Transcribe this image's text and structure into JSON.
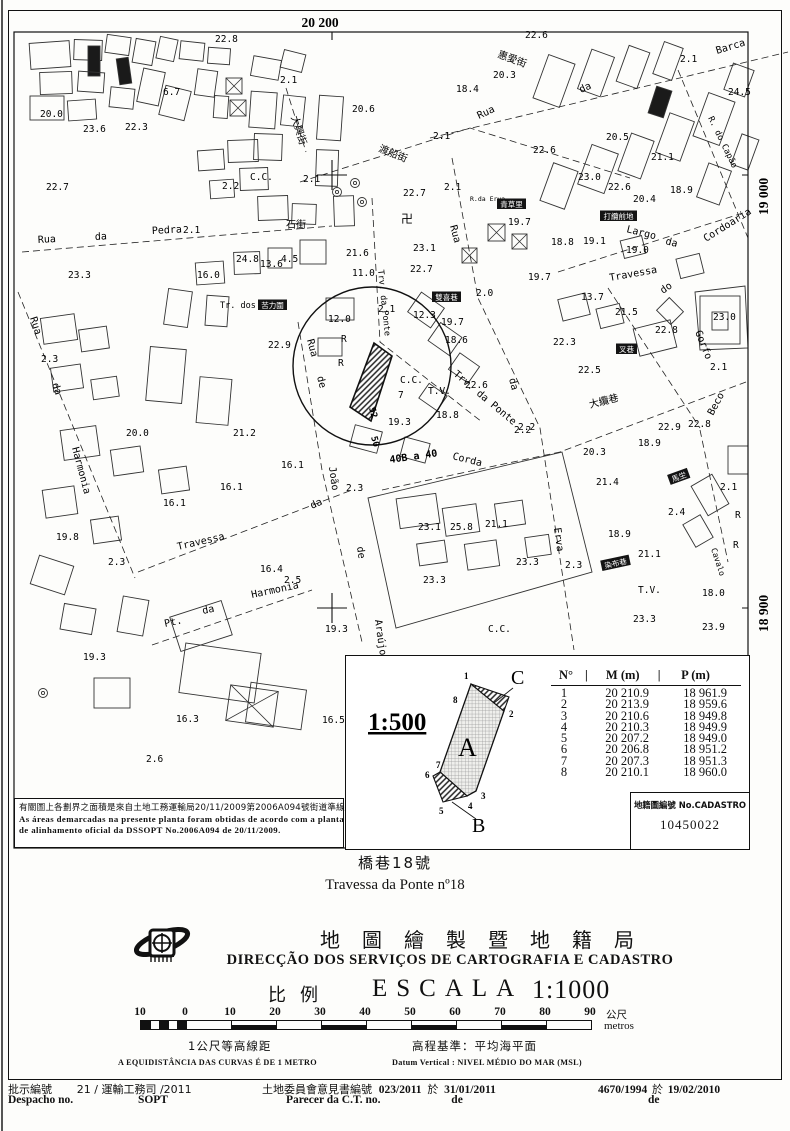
{
  "map": {
    "grid": {
      "top": "20 200",
      "right_upper": "19 000",
      "right_lower": "18 900"
    },
    "street_labels": [
      [
        "惠愛街",
        497,
        57,
        20,
        "zh"
      ],
      [
        "渡船街",
        378,
        151,
        22,
        "zh"
      ],
      [
        "大興街",
        291,
        117,
        72,
        "zh"
      ],
      [
        "石街",
        286,
        228,
        0,
        "zh"
      ],
      [
        "Rua",
        38,
        243,
        -3
      ],
      [
        "da",
        95,
        240,
        -3
      ],
      [
        "Pedra",
        152,
        234,
        -3
      ],
      [
        "Rua",
        30,
        318,
        72
      ],
      [
        "da",
        52,
        384,
        72
      ],
      [
        "Harmonia",
        72,
        448,
        75
      ],
      [
        "Travessa",
        178,
        550,
        -13
      ],
      [
        "da",
        312,
        509,
        -25
      ],
      [
        "Pt.",
        165,
        627,
        -12
      ],
      [
        "da",
        203,
        614,
        -12
      ],
      [
        "Harmonia",
        252,
        598,
        -12
      ],
      [
        "Tr. dos Cules",
        220,
        308,
        0,
        "mo",
        8.5
      ],
      [
        "Rua",
        307,
        340,
        75
      ],
      [
        "de",
        317,
        377,
        75
      ],
      [
        "João",
        329,
        467,
        82
      ],
      [
        "de",
        357,
        547,
        82
      ],
      [
        "Araújo",
        375,
        620,
        82
      ],
      [
        "Trv. da Ponte",
        378,
        270,
        84,
        "mo",
        8.5
      ],
      [
        "Trv. da Ponte",
        453,
        375,
        40
      ],
      [
        "Corda",
        452,
        459,
        14
      ],
      [
        "Rua",
        450,
        226,
        75
      ],
      [
        "da",
        509,
        379,
        75
      ],
      [
        "Erva",
        554,
        528,
        82
      ],
      [
        "Rua",
        479,
        119,
        -25
      ],
      [
        "da",
        581,
        93,
        -25
      ],
      [
        "Barca",
        717,
        54,
        -17
      ],
      [
        "R. do Capão",
        708,
        118,
        64,
        "mo",
        8.5
      ],
      [
        "Largo",
        626,
        232,
        14
      ],
      [
        "da",
        665,
        244,
        14
      ],
      [
        "Cordoaria",
        706,
        242,
        -32
      ],
      [
        "Travessa",
        610,
        281,
        -10
      ],
      [
        "do",
        663,
        294,
        -35
      ],
      [
        "Gorfo",
        695,
        332,
        68
      ],
      [
        "大纜巷",
        590,
        408,
        -14,
        "zh"
      ],
      [
        "Beco",
        713,
        416,
        -62
      ],
      [
        "Cavalo",
        711,
        549,
        72,
        "mo",
        8
      ],
      [
        "R.da Erva",
        470,
        201,
        0,
        "mo",
        6.5
      ],
      [
        "52",
        369,
        408,
        75,
        "bd",
        9
      ],
      [
        "50",
        371,
        437,
        75,
        "bd",
        9
      ],
      [
        "40B a 40",
        390,
        463,
        -8,
        "bd",
        10
      ]
    ],
    "chips": [
      [
        "雙喜巷",
        432,
        300,
        0
      ],
      [
        "打纜前地",
        600,
        219,
        0
      ],
      [
        "染布巷",
        602,
        569,
        -12
      ],
      [
        "苦力圍",
        258,
        308,
        0
      ],
      [
        "青草里",
        497,
        207,
        0
      ],
      [
        "馬坣",
        670,
        483,
        -20
      ],
      [
        "叉巷",
        616,
        352,
        0
      ]
    ],
    "elevations": [
      [
        "22.8",
        215,
        42
      ],
      [
        "2.1",
        280,
        83
      ],
      [
        "20.0",
        40,
        117
      ],
      [
        "23.6",
        83,
        132
      ],
      [
        "22.3",
        125,
        130
      ],
      [
        "6.7",
        163,
        95
      ],
      [
        "22.7",
        46,
        190
      ],
      [
        "C.C.",
        250,
        180
      ],
      [
        "20.6",
        352,
        112
      ],
      [
        "2.1",
        303,
        182
      ],
      [
        "2.2",
        222,
        189
      ],
      [
        "2.1",
        433,
        139
      ],
      [
        "22.7",
        403,
        196
      ],
      [
        "2.1",
        444,
        190
      ],
      [
        "23.1",
        413,
        251
      ],
      [
        "22.7",
        410,
        272
      ],
      [
        "21.6",
        346,
        256
      ],
      [
        "11.0",
        352,
        276
      ],
      [
        "2.1",
        183,
        233
      ],
      [
        "23.3",
        68,
        278
      ],
      [
        "16.0",
        197,
        278
      ],
      [
        "24.8",
        236,
        262
      ],
      [
        "13.6",
        260,
        267
      ],
      [
        "4.5",
        281,
        262
      ],
      [
        "22.9",
        268,
        348
      ],
      [
        "2.3",
        41,
        362
      ],
      [
        "20.0",
        126,
        436
      ],
      [
        "21.2",
        233,
        436
      ],
      [
        "16.1",
        281,
        468
      ],
      [
        "16.1",
        220,
        490
      ],
      [
        "16.1",
        163,
        506
      ],
      [
        "19.8",
        56,
        540
      ],
      [
        "2.3",
        108,
        565
      ],
      [
        "16.4",
        260,
        572
      ],
      [
        "2.5",
        284,
        583
      ],
      [
        "19.3",
        325,
        632
      ],
      [
        "19.3",
        83,
        660
      ],
      [
        "16.3",
        176,
        722
      ],
      [
        "2.6",
        146,
        762
      ],
      [
        "16.5",
        322,
        723
      ],
      [
        "12.0",
        328,
        322
      ],
      [
        "2.1",
        378,
        312
      ],
      [
        "12.3",
        413,
        318
      ],
      [
        "19.7",
        441,
        325
      ],
      [
        "18.6",
        445,
        343
      ],
      [
        "2.0",
        476,
        296
      ],
      [
        "22.6",
        465,
        388
      ],
      [
        "18.8",
        436,
        418
      ],
      [
        "19.3",
        388,
        425
      ],
      [
        "7",
        398,
        398
      ],
      [
        "2.2",
        514,
        433
      ],
      [
        "R",
        341,
        342
      ],
      [
        "R",
        338,
        366
      ],
      [
        "C.C.",
        400,
        383
      ],
      [
        "2.3",
        346,
        491
      ],
      [
        "23.1",
        418,
        530
      ],
      [
        "25.8",
        450,
        530
      ],
      [
        "21.1",
        485,
        527
      ],
      [
        "23.3",
        516,
        565
      ],
      [
        "23.3",
        423,
        583
      ],
      [
        "2.3",
        565,
        568
      ],
      [
        "C.C.",
        488,
        632
      ],
      [
        "18.4",
        456,
        92
      ],
      [
        "20.3",
        493,
        78
      ],
      [
        "22.6",
        525,
        38
      ],
      [
        "2.1",
        680,
        62
      ],
      [
        "24.5",
        728,
        95
      ],
      [
        "22.6",
        533,
        153
      ],
      [
        "23.0",
        578,
        180
      ],
      [
        "20.5",
        606,
        140
      ],
      [
        "21.1",
        651,
        160
      ],
      [
        "18.9",
        670,
        193
      ],
      [
        "20.4",
        633,
        202
      ],
      [
        "22.6",
        608,
        190
      ],
      [
        "19.7",
        508,
        225
      ],
      [
        "18.8",
        551,
        245
      ],
      [
        "19.1",
        583,
        244
      ],
      [
        "19.0",
        626,
        253
      ],
      [
        "19.7",
        528,
        280
      ],
      [
        "13.7",
        581,
        300
      ],
      [
        "21.5",
        615,
        315
      ],
      [
        "23.0",
        713,
        320
      ],
      [
        "22.8",
        655,
        333
      ],
      [
        "22.3",
        553,
        345
      ],
      [
        "22.5",
        578,
        373
      ],
      [
        "2.1",
        710,
        370
      ],
      [
        "2.2",
        518,
        430
      ],
      [
        "22.9",
        658,
        430
      ],
      [
        "22.8",
        688,
        427
      ],
      [
        "18.9",
        638,
        446
      ],
      [
        "20.3",
        583,
        455
      ],
      [
        "21.4",
        596,
        485
      ],
      [
        "2.1",
        720,
        490
      ],
      [
        "2.4",
        668,
        515
      ],
      [
        "18.9",
        608,
        537
      ],
      [
        "21.1",
        638,
        557
      ],
      [
        "23.3",
        633,
        622
      ],
      [
        "18.0",
        702,
        596
      ],
      [
        "23.9",
        702,
        630
      ],
      [
        "R",
        735,
        518
      ],
      [
        "R",
        733,
        548
      ],
      [
        "T.V.",
        638,
        593
      ],
      [
        "T.V.",
        428,
        394
      ]
    ]
  },
  "note": {
    "line_zh": "有關圖上各劃界之面積是來自土地工務運輸局20/11/2009第2006A094號街道準線圖.",
    "line_pt1": "As áreas demarcadas na presente planta foram obtidas de acordo com a planta",
    "line_pt2": "de alinhamento oficial da DSSOPT No.2006A094 de 20/11/2009."
  },
  "inset": {
    "scale": "1:500",
    "zones": [
      "A",
      "B",
      "C"
    ],
    "vertices": [
      "1",
      "2",
      "3",
      "4",
      "5",
      "6",
      "7",
      "8"
    ]
  },
  "table": {
    "headers": [
      "N°",
      "M (m)",
      "P (m)"
    ],
    "rows": [
      [
        "1",
        "20 210.9",
        "18 961.9"
      ],
      [
        "2",
        "20 213.9",
        "18 959.6"
      ],
      [
        "3",
        "20 210.6",
        "18 949.8"
      ],
      [
        "4",
        "20 210.3",
        "18 949.9"
      ],
      [
        "5",
        "20 207.2",
        "18 949.0"
      ],
      [
        "6",
        "20 206.8",
        "18 951.2"
      ],
      [
        "7",
        "20 207.3",
        "18 951.3"
      ],
      [
        "8",
        "20 210.1",
        "18 960.0"
      ]
    ]
  },
  "cadastro": {
    "label": "地籍圖編號 No.CADASTRO",
    "number": "10450022"
  },
  "title": {
    "zh": "橋巷18號",
    "pt": "Travessa da Ponte nº18"
  },
  "agency": {
    "zh": "地圖繪製暨地籍局",
    "pt": "DIRECÇÃO DOS SERVIÇOS DE CARTOGRAFIA E CADASTRO"
  },
  "scale": {
    "zh": "比例",
    "pt": "ESCALA",
    "value": "1:1000"
  },
  "scalebar": {
    "ticks": [
      "10",
      "0",
      "10",
      "20",
      "30",
      "40",
      "50",
      "60",
      "70",
      "80",
      "90"
    ],
    "unit_zh": "公尺",
    "unit_pt": "metros"
  },
  "contour": {
    "zh": "1公尺等高線距",
    "pt": "A EQUIDISTÂNCIA DAS CURVAS É DE 1 METRO"
  },
  "datum": {
    "zh": "高程基準：平均海平面",
    "pt": "Datum Vertical : NIVEL MÉDIO DO MAR (MSL)"
  },
  "footer": {
    "despacho_zh": "批示編號",
    "despacho_pt": "Despacho no.",
    "despacho_value": "21 / 運輸工務司 /2011",
    "despacho_value2": "SOPT",
    "parecer_zh": "土地委員會意見書編號",
    "parecer_value": "023/2011",
    "parecer_on": "於",
    "parecer_date": "31/01/2011",
    "parecer_pt": "Parecer da C.T. no.",
    "parecer_pt2": "de",
    "right_value": "4670/1994",
    "right_on": "於",
    "right_date": "19/02/2010",
    "right_pt": "de"
  }
}
